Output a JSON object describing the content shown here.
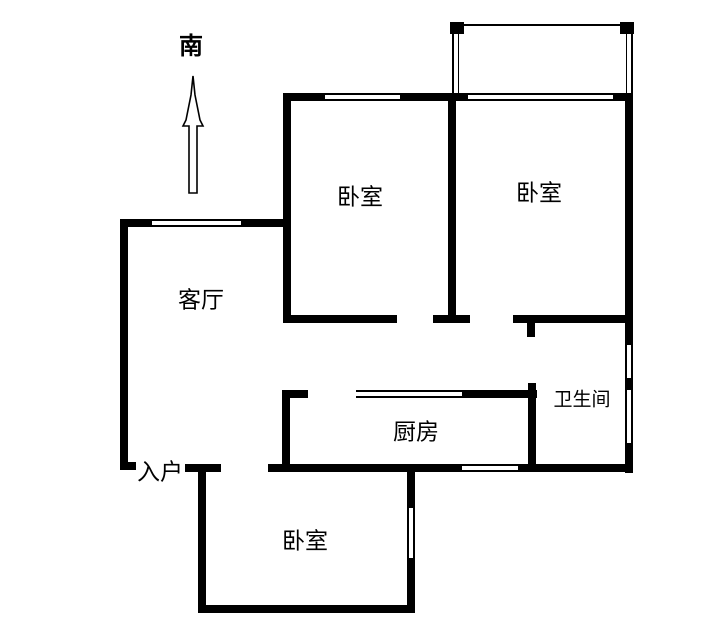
{
  "title": "apartment-floor-plan",
  "compass": {
    "south_label": "南"
  },
  "rooms": {
    "living_room": {
      "label": "客厅"
    },
    "bedroom_middle": {
      "label": "卧室"
    },
    "bedroom_right": {
      "label": "卧室"
    },
    "bedroom_bottom": {
      "label": "卧室"
    },
    "kitchen": {
      "label": "厨房"
    },
    "bathroom": {
      "label": "卫生间"
    },
    "entrance": {
      "label": "入户"
    }
  },
  "colors": {
    "wall": "#000000",
    "background": "#ffffff"
  }
}
